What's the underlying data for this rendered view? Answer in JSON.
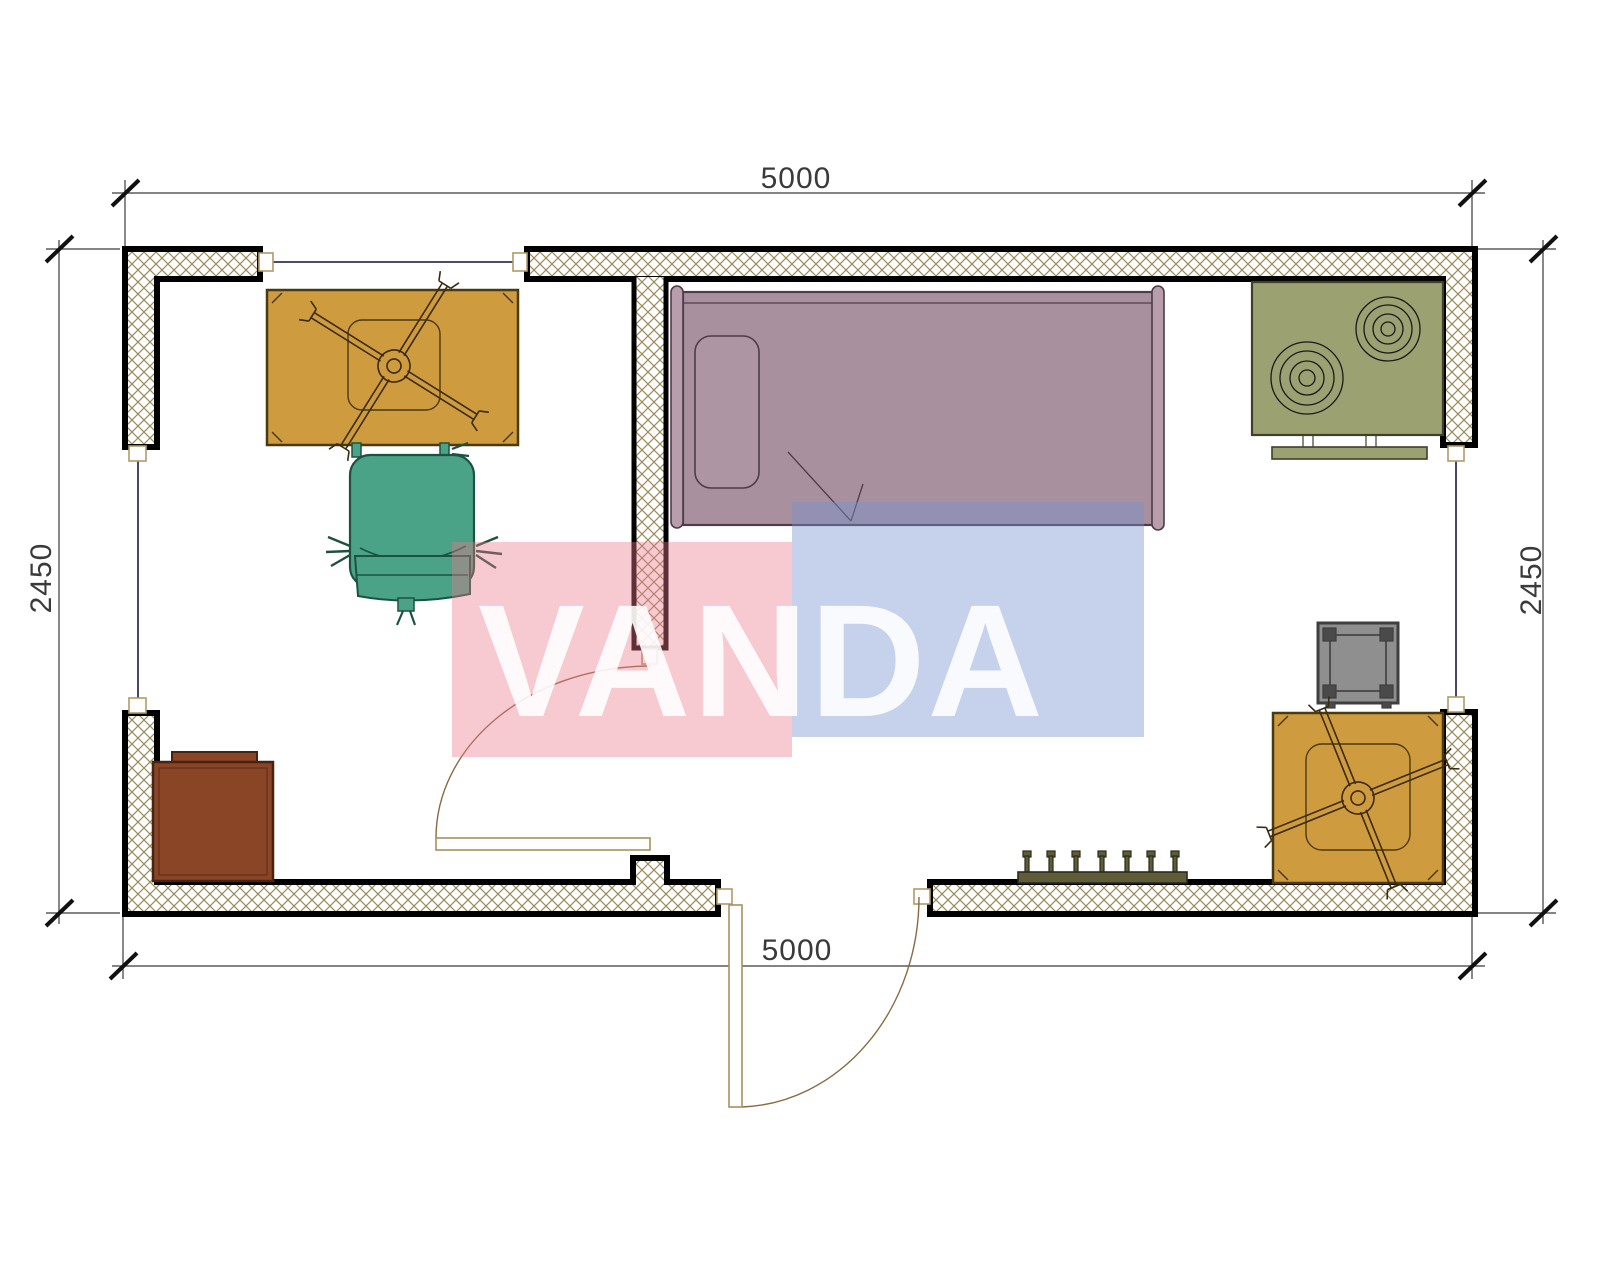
{
  "drawing": {
    "type": "floor-plan",
    "dimensions": {
      "top_width": "5000",
      "bottom_width": "5000",
      "left_height": "2450",
      "right_height": "2450"
    },
    "watermark": {
      "text": "VANDA",
      "text_color": "#ffffff",
      "pink_color": "rgba(235,120,138,0.40)",
      "blue_color": "rgba(118,148,208,0.42)"
    },
    "colors": {
      "wall_hatch": "#9a8a5a",
      "wall_outline": "#000000",
      "dimension": "#3a3a3a",
      "window_line": "#333355",
      "door": "#8a6a42",
      "table": "#cf9b3f",
      "table_detail": "#4a3a10",
      "chair": "#4aa287",
      "chair_detail": "#1d5240",
      "bed": "#a8909e",
      "pillow": "#ae95a4",
      "bed_rail": "#b89dac",
      "stove": "#9ba171",
      "stove_detail": "#3f3f2a",
      "cabinet": "#8a4527",
      "cabinet_detail": "#4a2310",
      "side_table": "#8f8f8f",
      "side_table_detail": "#4a4a4a",
      "radiator": "#5f5c38",
      "radiator_detail": "#2a2a1a"
    }
  }
}
